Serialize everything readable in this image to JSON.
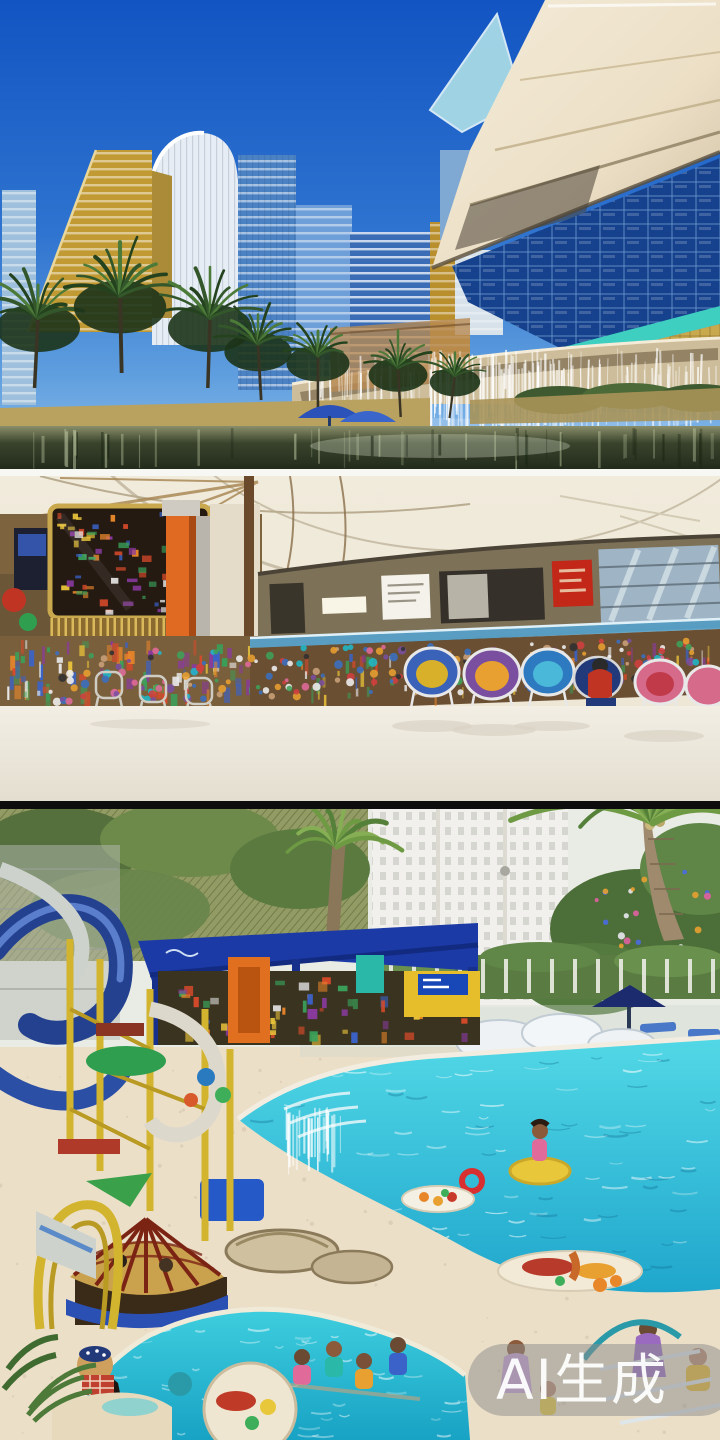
{
  "watermark": {
    "label": "AI生成",
    "background": "#8c8c8c",
    "text_color": "#ffffff"
  },
  "panels": [
    {
      "id": "resort-towers"
    },
    {
      "id": "mall-concourse"
    },
    {
      "id": "waterpark-pool"
    }
  ],
  "palette": {
    "sky_top": "#1254c2",
    "sky_bottom": "#8fc0ec",
    "gold_tower": "#c29a33",
    "glass_tower": "#3a6db6",
    "cream_band": "#ecdfc6",
    "blue_panel": "#16418c",
    "teal_stripe": "#3ecfc0",
    "water_dark": "#39432c",
    "ceiling_cream": "#ece5d4",
    "orange_column": "#e06a22",
    "mall_floor": "#f2eee4",
    "railing_blue": "#57a0c8",
    "pool_light": "#52d8e6",
    "pool_deep": "#1fa6cc",
    "deck_sand": "#ecdfc8",
    "pavilion_blue": "#1c3aa6",
    "slide_blue": "#24418f",
    "dome_rib_red": "#7c2414",
    "frame_yellow": "#d2b42e",
    "palm_green": "#55803a"
  }
}
